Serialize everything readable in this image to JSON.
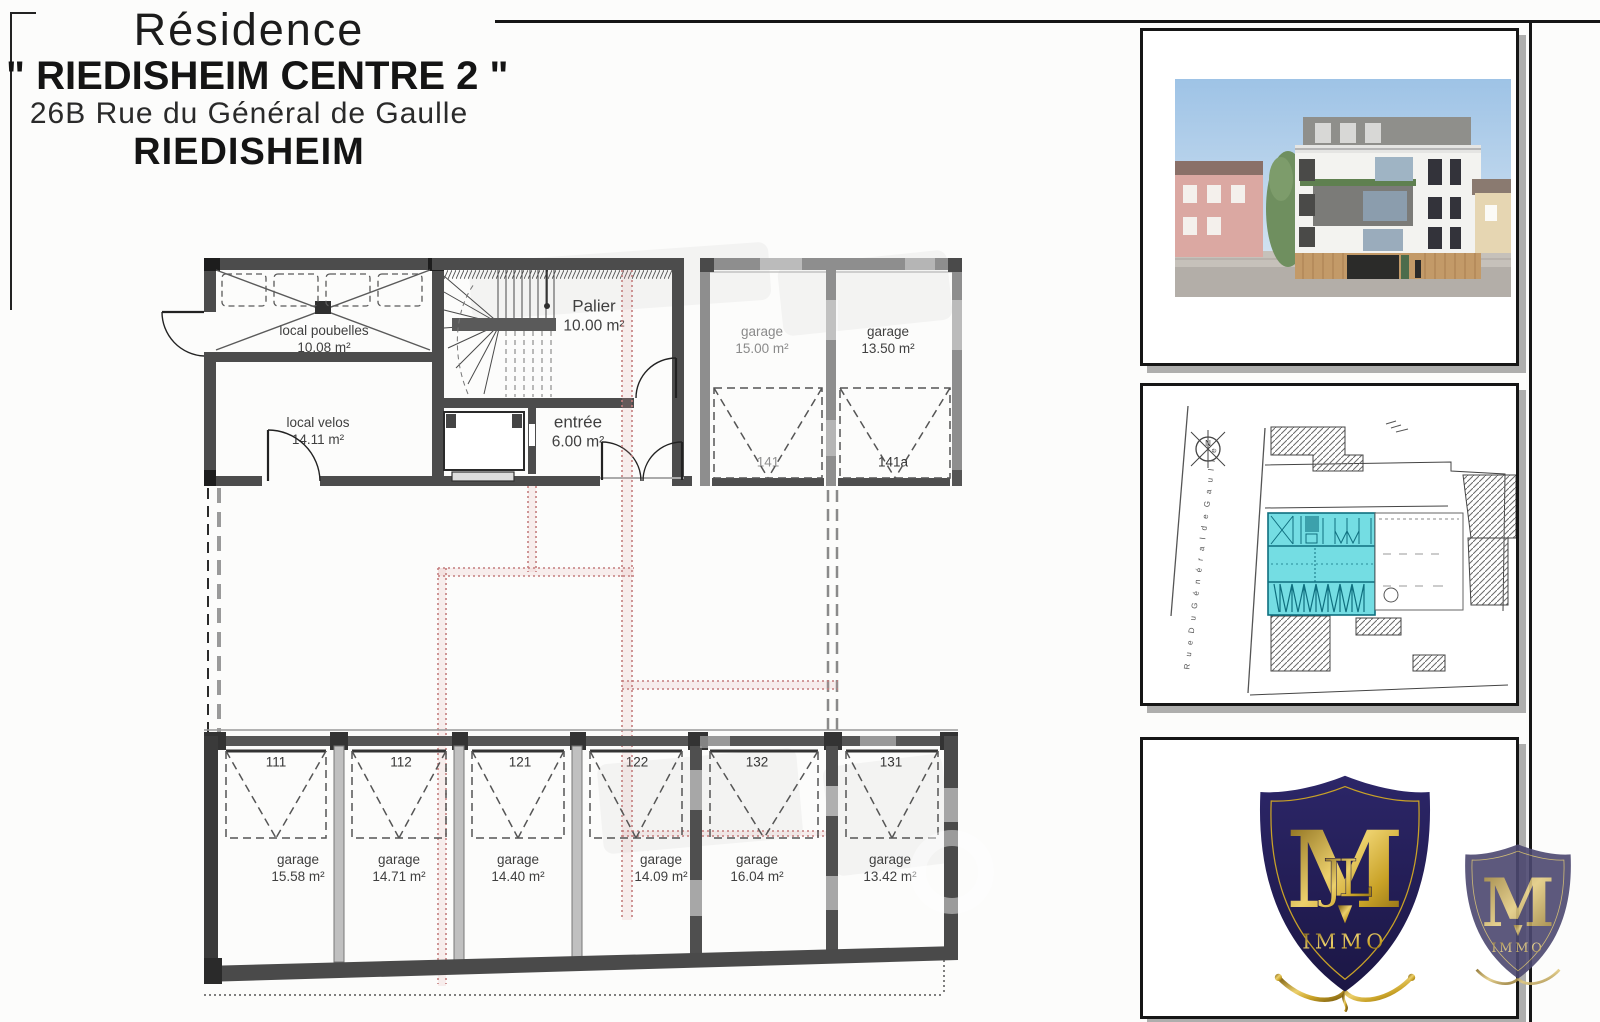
{
  "header": {
    "line1": "Résidence",
    "line2": "\" RIEDISHEIM CENTRE 2 \"",
    "line3": "26B Rue du Général de Gaulle",
    "line4": "RIEDISHEIM"
  },
  "floor_plan": {
    "rooms": {
      "poubelles": {
        "name": "local poubelles",
        "area": "10.08 m²"
      },
      "velos": {
        "name": "local velos",
        "area": "14.11 m²"
      },
      "palier": {
        "name": "Palier",
        "area": "10.00 m²"
      },
      "entree": {
        "name": "entrée",
        "area": "6.00 m²"
      }
    },
    "elevator": {
      "name": "ASCENSEUR",
      "capacity": "630Kg",
      "persons": "8 personnes"
    },
    "garages_upper": [
      {
        "label": "garage",
        "area": "15.00 m²",
        "number": "141"
      },
      {
        "label": "garage",
        "area": "13.50 m²",
        "number": "141a"
      }
    ],
    "garages_lower": [
      {
        "number": "111",
        "label": "garage",
        "area": "15.58 m²"
      },
      {
        "number": "112",
        "label": "garage",
        "area": "14.71 m²"
      },
      {
        "number": "121",
        "label": "garage",
        "area": "14.40 m²"
      },
      {
        "number": "122",
        "label": "garage",
        "area": "14.09 m²"
      },
      {
        "number": "132",
        "label": "garage",
        "area": "16.04 m²"
      },
      {
        "number": "131",
        "label": "garage",
        "area": "13.42 m²"
      }
    ]
  },
  "site_plan": {
    "street_name": "R u e   D u   G é n é r a l   d e   G a u l l e",
    "north_label": "N"
  },
  "logo": {
    "monogram_main": "M",
    "monogram_overlay": "JL",
    "brand": "IMMO"
  },
  "colors": {
    "wall_dark": "#4c4c4c",
    "wall_gray": "#8e8e8e",
    "path_red": "#c47d7d",
    "site_highlight": "#74dde3",
    "shield_navy": "#241f55",
    "gold": "#c9a227"
  }
}
